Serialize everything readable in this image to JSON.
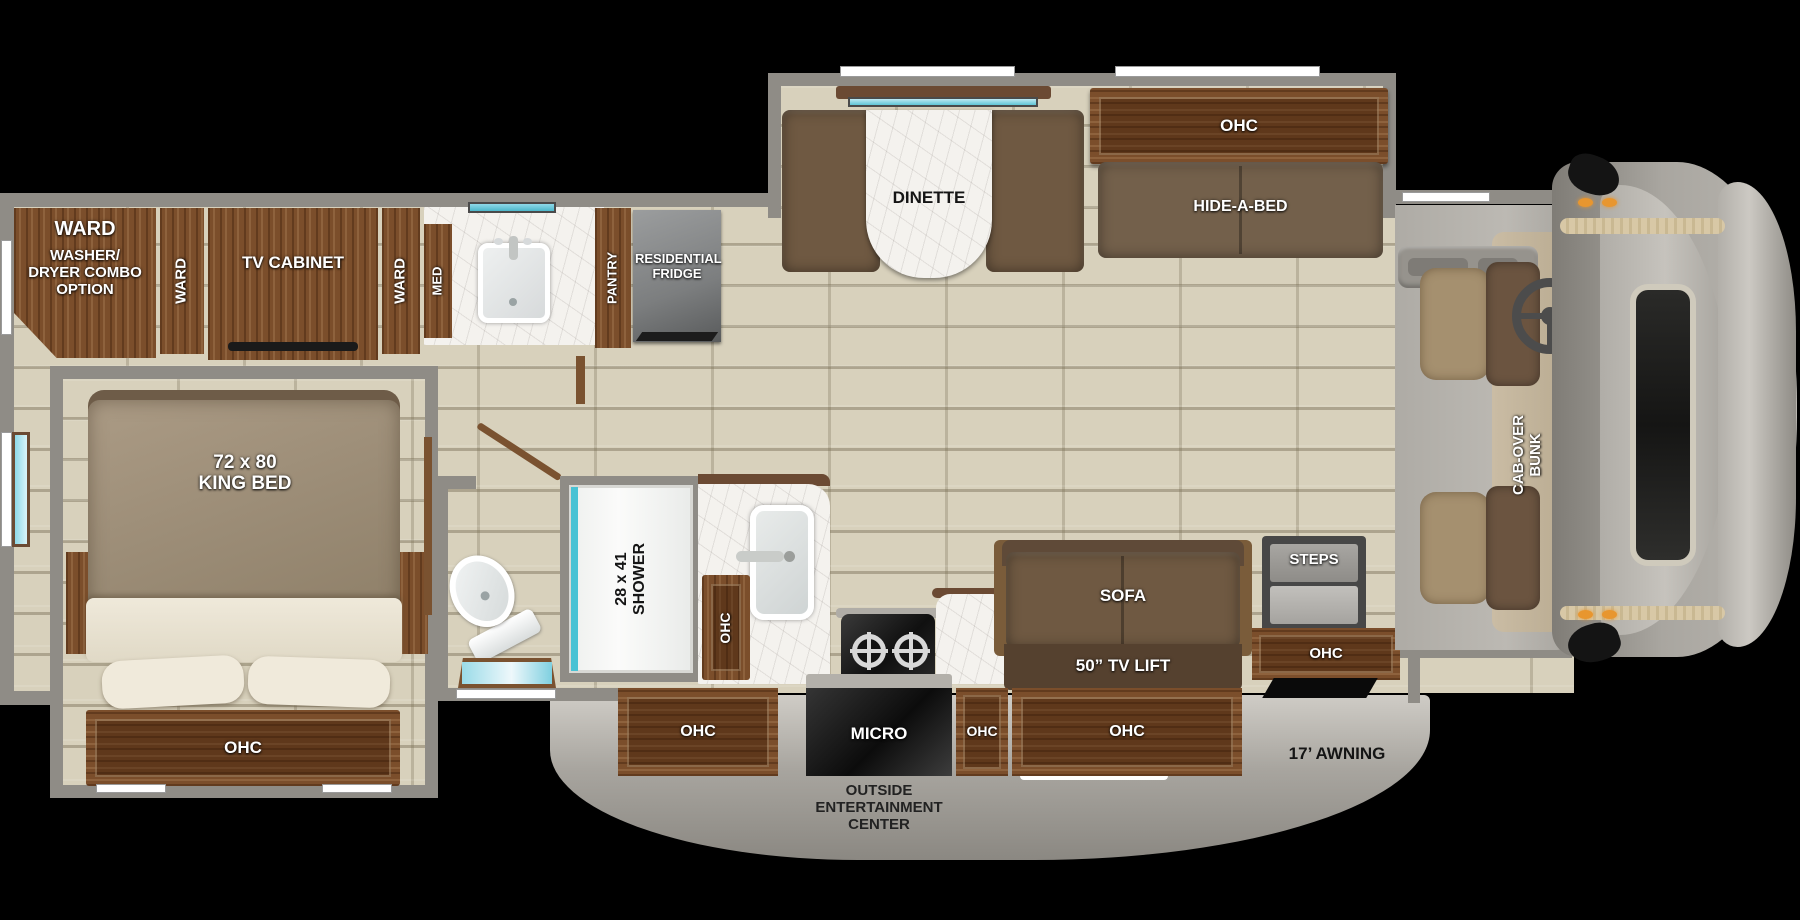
{
  "title": "Class C motorhome floor plan",
  "colors": {
    "wall": "#8f8c86",
    "floor_tile": "#d8d1bc",
    "cabinet_wood": "#7b4e2b",
    "upholstery_brown": "#6f5942",
    "window_glass": "#4db7ca",
    "marble_counter": "#f4f2ee",
    "exterior_gray": "#b5b2ac",
    "marker_light_orange": "#e8962f"
  },
  "rear": {
    "ward_corner": "WARD",
    "washer_dryer": "WASHER/ DRYER COMBO OPTION",
    "ward_left": "WARD",
    "tv_cabinet": "TV CABINET",
    "ward_right": "WARD"
  },
  "bath_front": {
    "med": "MED",
    "pantry": "PANTRY",
    "fridge": "RESIDENTIAL FRIDGE"
  },
  "dinette": {
    "label": "DINETTE",
    "ohc": "OHC",
    "hide_a_bed": "HIDE-A-BED"
  },
  "cab": {
    "bunk": "CAB-OVER BUNK"
  },
  "bedroom": {
    "bed_size": "72 x 80",
    "bed_type": "KING BED",
    "ohc": "OHC"
  },
  "bath_rear": {
    "shower_size": "28 x 41",
    "shower": "SHOWER"
  },
  "kitchen": {
    "ohc_sink": "OHC",
    "ohc_left": "OHC",
    "micro": "MICRO",
    "ohc_right": "OHC"
  },
  "living": {
    "sofa": "SOFA",
    "tv_lift": "50” TV LIFT",
    "ohc": "OHC"
  },
  "entry": {
    "steps": "STEPS",
    "ohc": "OHC"
  },
  "exterior": {
    "awning": "17’ AWNING",
    "outside_entertainment": "OUTSIDE ENTERTAINMENT CENTER"
  }
}
